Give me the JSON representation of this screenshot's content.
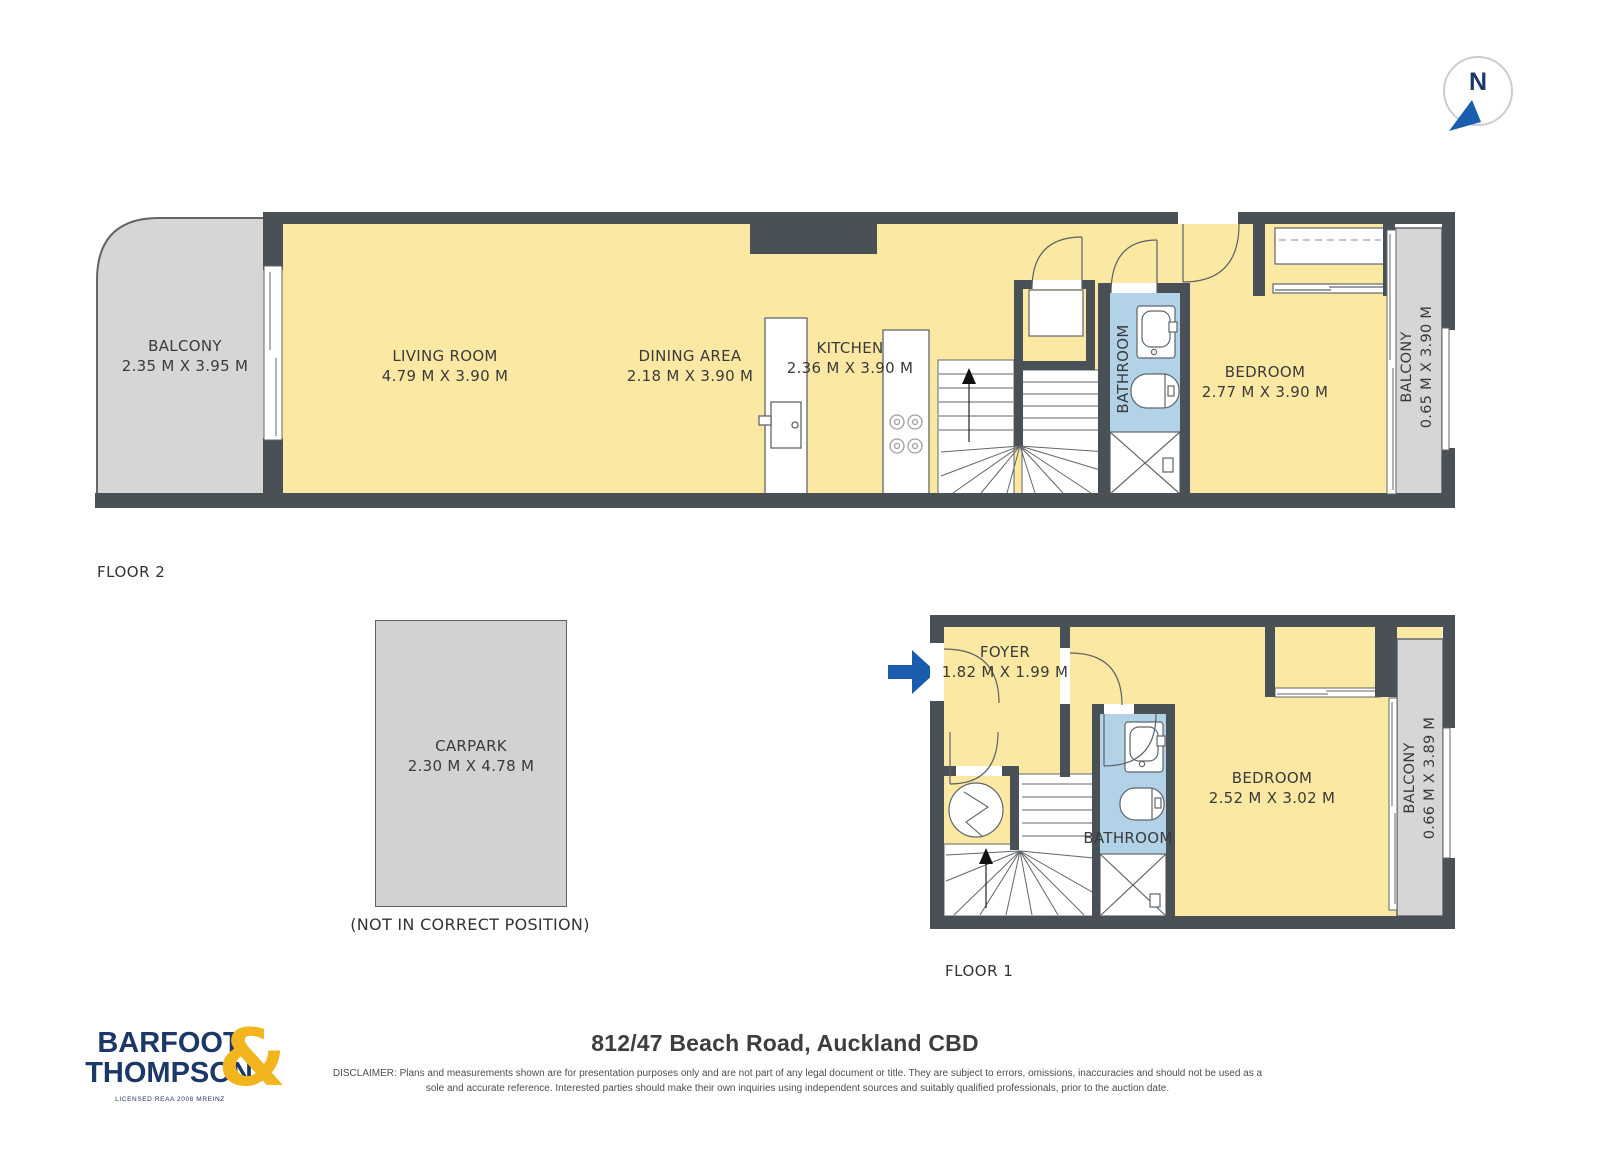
{
  "north": {
    "label": "N"
  },
  "floor2": {
    "label": "FLOOR 2",
    "balcony_left": {
      "name": "BALCONY",
      "dims": "2.35 M X 3.95 M"
    },
    "living_room": {
      "name": "LIVING ROOM",
      "dims": "4.79 M X 3.90 M"
    },
    "dining_area": {
      "name": "DINING AREA",
      "dims": "2.18 M X 3.90 M"
    },
    "kitchen": {
      "name": "KITCHEN",
      "dims": "2.36 M X 3.90 M"
    },
    "bathroom": {
      "name": "BATHROOM"
    },
    "bedroom": {
      "name": "BEDROOM",
      "dims": "2.77 M X 3.90 M"
    },
    "balcony_right": {
      "name": "BALCONY",
      "dims": "0.65 M X 3.90 M"
    }
  },
  "carpark": {
    "name": "CARPARK",
    "dims": "2.30 M X 4.78 M",
    "note": "(NOT IN CORRECT POSITION)"
  },
  "floor1": {
    "label": "FLOOR 1",
    "foyer": {
      "name": "FOYER",
      "dims": "1.82 M X 1.99 M"
    },
    "bathroom": {
      "name": "BATHROOM"
    },
    "bedroom": {
      "name": "BEDROOM",
      "dims": "2.52 M X 3.02 M"
    },
    "balcony": {
      "name": "BALCONY",
      "dims": "0.66 M X 3.89 M"
    }
  },
  "footer": {
    "brand_line1": "BARFOOT",
    "brand_line2": "THOMPSON",
    "brand_ampersand": "&",
    "brand_license": "LICENSED REAA 2008 MREINZ",
    "address_title": "812/47 Beach Road, Auckland CBD",
    "disclaimer": "DISCLAIMER: Plans and measurements shown are for presentation purposes only and are not part of any legal document or title. They are subject to errors, omissions, inaccuracies and should not be used as a sole and accurate reference. Interested parties should make their own inquiries using independent sources and suitably qualified professionals, prior to the auction date."
  },
  "colors": {
    "wall": "#4A5156",
    "room_fill": "#FBE9A3",
    "bathroom_fill": "#B2D2E7",
    "balcony_fill": "#D6D6D6",
    "brand_navy": "#1C3869",
    "brand_gold": "#F2B51D",
    "arrow_blue": "#1A5CAD"
  }
}
